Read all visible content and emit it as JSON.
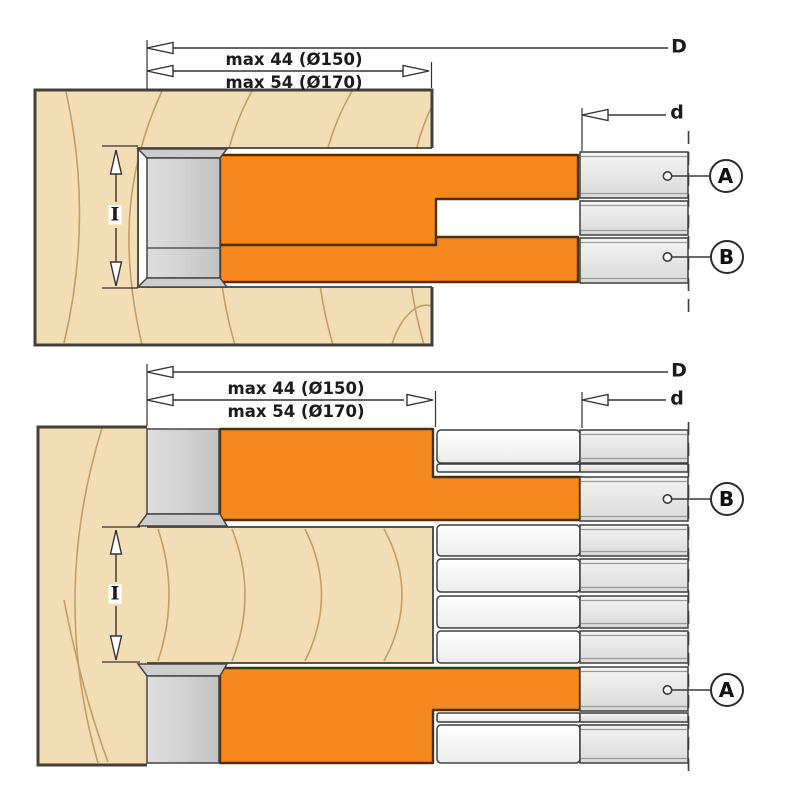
{
  "colors": {
    "background": "#FFFFFF",
    "cutter_orange": "#F6891E",
    "wood_fill": "#F2DDB5",
    "wood_grain": "#C49D66",
    "steel_light": "#F4F4F4",
    "steel_dark": "#D9D9D9",
    "hub_gray": "#D2D2D2",
    "outline": "#3E3E3E"
  },
  "top_view": {
    "dim_D": "D",
    "dim_d": "d",
    "dim_I": "I",
    "max_row1": "max 44 (Ø150)",
    "max_row2": "max 54 (Ø170)",
    "callout_A": "A",
    "callout_B": "B"
  },
  "bottom_view": {
    "dim_D": "D",
    "dim_d": "d",
    "dim_I": "I",
    "max_row1": "max 44 (Ø150)",
    "max_row2": "max 54 (Ø170)",
    "callout_A": "A",
    "callout_B": "B"
  }
}
